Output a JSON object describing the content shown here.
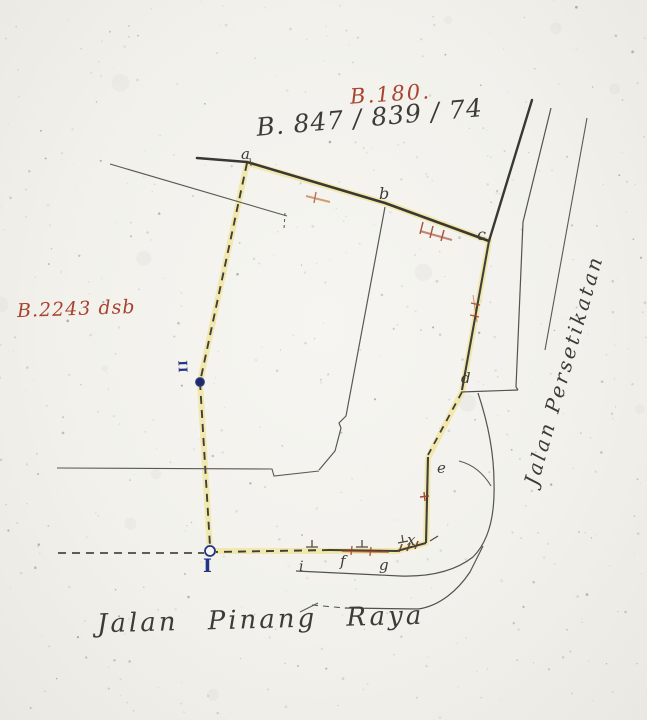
{
  "annotations": {
    "block_red": "B.180.",
    "lots_black": "B. 847 / 839 / 74",
    "neighbor_red": "B.2243 dsb"
  },
  "roads": {
    "east": "Jalan Persetikatan",
    "south": "Jalan Pinang Raya"
  },
  "points": [
    "a",
    "b",
    "c",
    "d",
    "e",
    "x",
    "i",
    "f",
    "g"
  ],
  "stations": [
    "I",
    "II"
  ],
  "colors": {
    "paper": "#f4f2ee",
    "pencil_ink": "#44423e",
    "red_ink": "#a8432f",
    "blue_ink": "#253487",
    "highlight_yellow": "#f0de6e",
    "hatch_red": "#a03a22"
  }
}
